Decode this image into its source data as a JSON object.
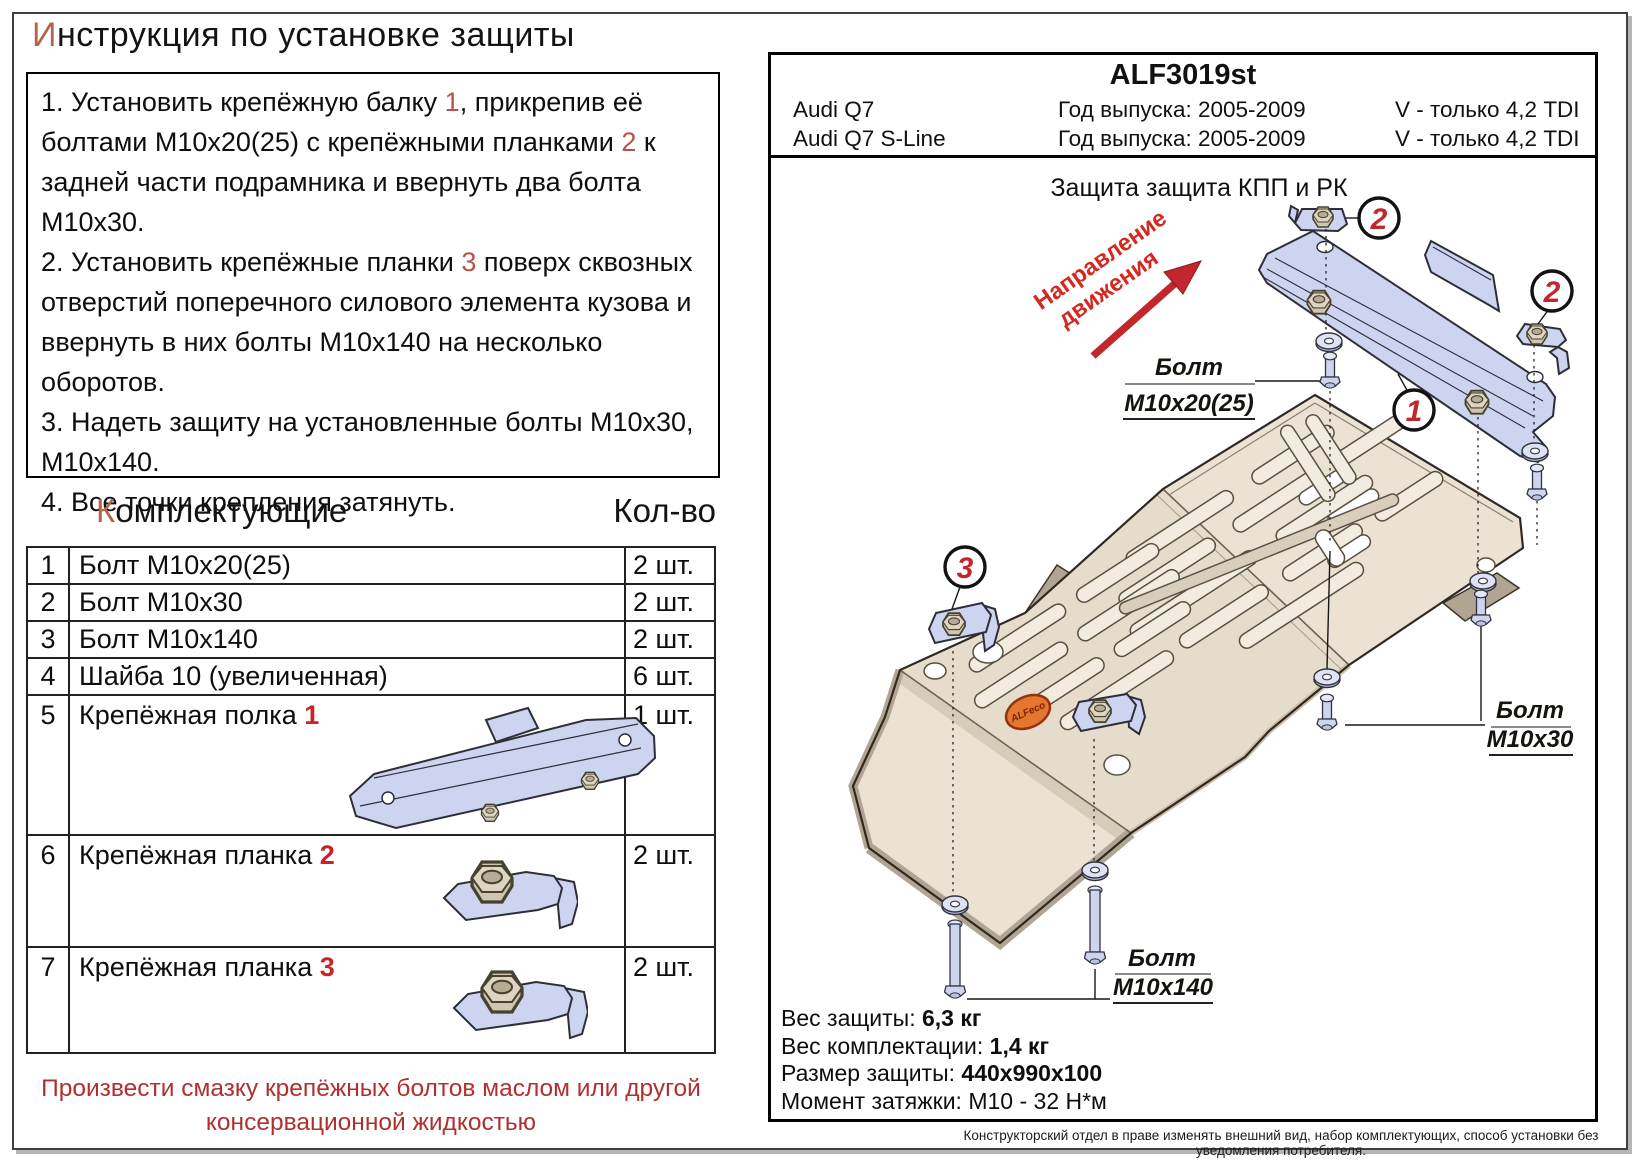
{
  "title": {
    "first": "И",
    "rest": "нструкция по установке защиты"
  },
  "instructions": {
    "s1a": "1. Установить крепёжную балку ",
    "s1n1": "1",
    "s1b": ", прикрепив её болтами М10х20(25) с крепёжными планками ",
    "s1n2": "2",
    "s1c": " к задней части подрамника и ввернуть два болта М10х30.",
    "s2a": "2. Установить крепёжные планки ",
    "s2n1": "3",
    "s2b": " поверх сквозных отверстий поперечного силового элемента кузова и ввернуть в них болты М10х140 на несколько оборотов.",
    "s3": "3. Надеть защиту на установленные болты М10х30, М10х140.",
    "s4": "4. Все точки крепления затянуть."
  },
  "components": {
    "header_first": "К",
    "header_rest": "омплектующие",
    "qty_header": "Кол-во",
    "rows": [
      {
        "num": "1",
        "name": "Болт М10х20(25)",
        "qty": "2 шт."
      },
      {
        "num": "2",
        "name": "Болт М10х30",
        "qty": "2 шт."
      },
      {
        "num": "3",
        "name": "Болт М10х140",
        "qty": "2 шт."
      },
      {
        "num": "4",
        "name": "Шайба 10 (увеличенная)",
        "qty": "6 шт."
      },
      {
        "num": "5",
        "name": "Крепёжная полка ",
        "ref": "1",
        "qty": "1 шт."
      },
      {
        "num": "6",
        "name": "Крепёжная планка ",
        "ref": "2",
        "qty": "2 шт."
      },
      {
        "num": "7",
        "name": "Крепёжная планка ",
        "ref": "3",
        "qty": "2 шт."
      }
    ]
  },
  "note": {
    "line1": "Произвести смазку крепёжных болтов маслом или другой",
    "line2": "консервационной жидкостью"
  },
  "panel": {
    "code": "ALF3019st",
    "models": [
      {
        "name": "Audi Q7",
        "year": "Год выпуска: 2005-2009",
        "engine": "V - только 4,2 TDI"
      },
      {
        "name": "Audi Q7 S-Line",
        "year": "Год выпуска: 2005-2009",
        "engine": "V - только 4,2 TDI"
      }
    ],
    "drawing": {
      "title": "Защита защита КПП и РК",
      "direction1": "Направление",
      "direction2": "движения",
      "bolt_word": "Болт",
      "bolt1": "М10х20(25)",
      "bolt2": "М10х30",
      "bolt3": "М10х140",
      "callout1": "1",
      "callout2": "2",
      "callout3": "3",
      "logo": "ALFeco"
    },
    "specs": [
      {
        "label": "Вес защиты: ",
        "value": "6,3 кг"
      },
      {
        "label": "Вес комплектации: ",
        "value": "1,4 кг"
      },
      {
        "label": "Размер защиты: ",
        "value": "440х990х100"
      },
      {
        "label": "Момент затяжки: ",
        "value": "М10 - 32 Н*м"
      }
    ],
    "disclaimer": "Конструкторский отдел в праве изменять внешний вид, набор комплектующих, способ установки без уведомления потребителя."
  },
  "colors": {
    "callout_red": "#c1272d",
    "ref_red": "#b5524e",
    "bold_ref_red": "#cc2127",
    "title_accent": "#b4644a",
    "note_red": "#b03030",
    "arrow_red": "#cf2b28",
    "logo_orange": "#e4762f",
    "part_blue": "#ccd4f0",
    "plate_beige": "#ebe2d4"
  }
}
